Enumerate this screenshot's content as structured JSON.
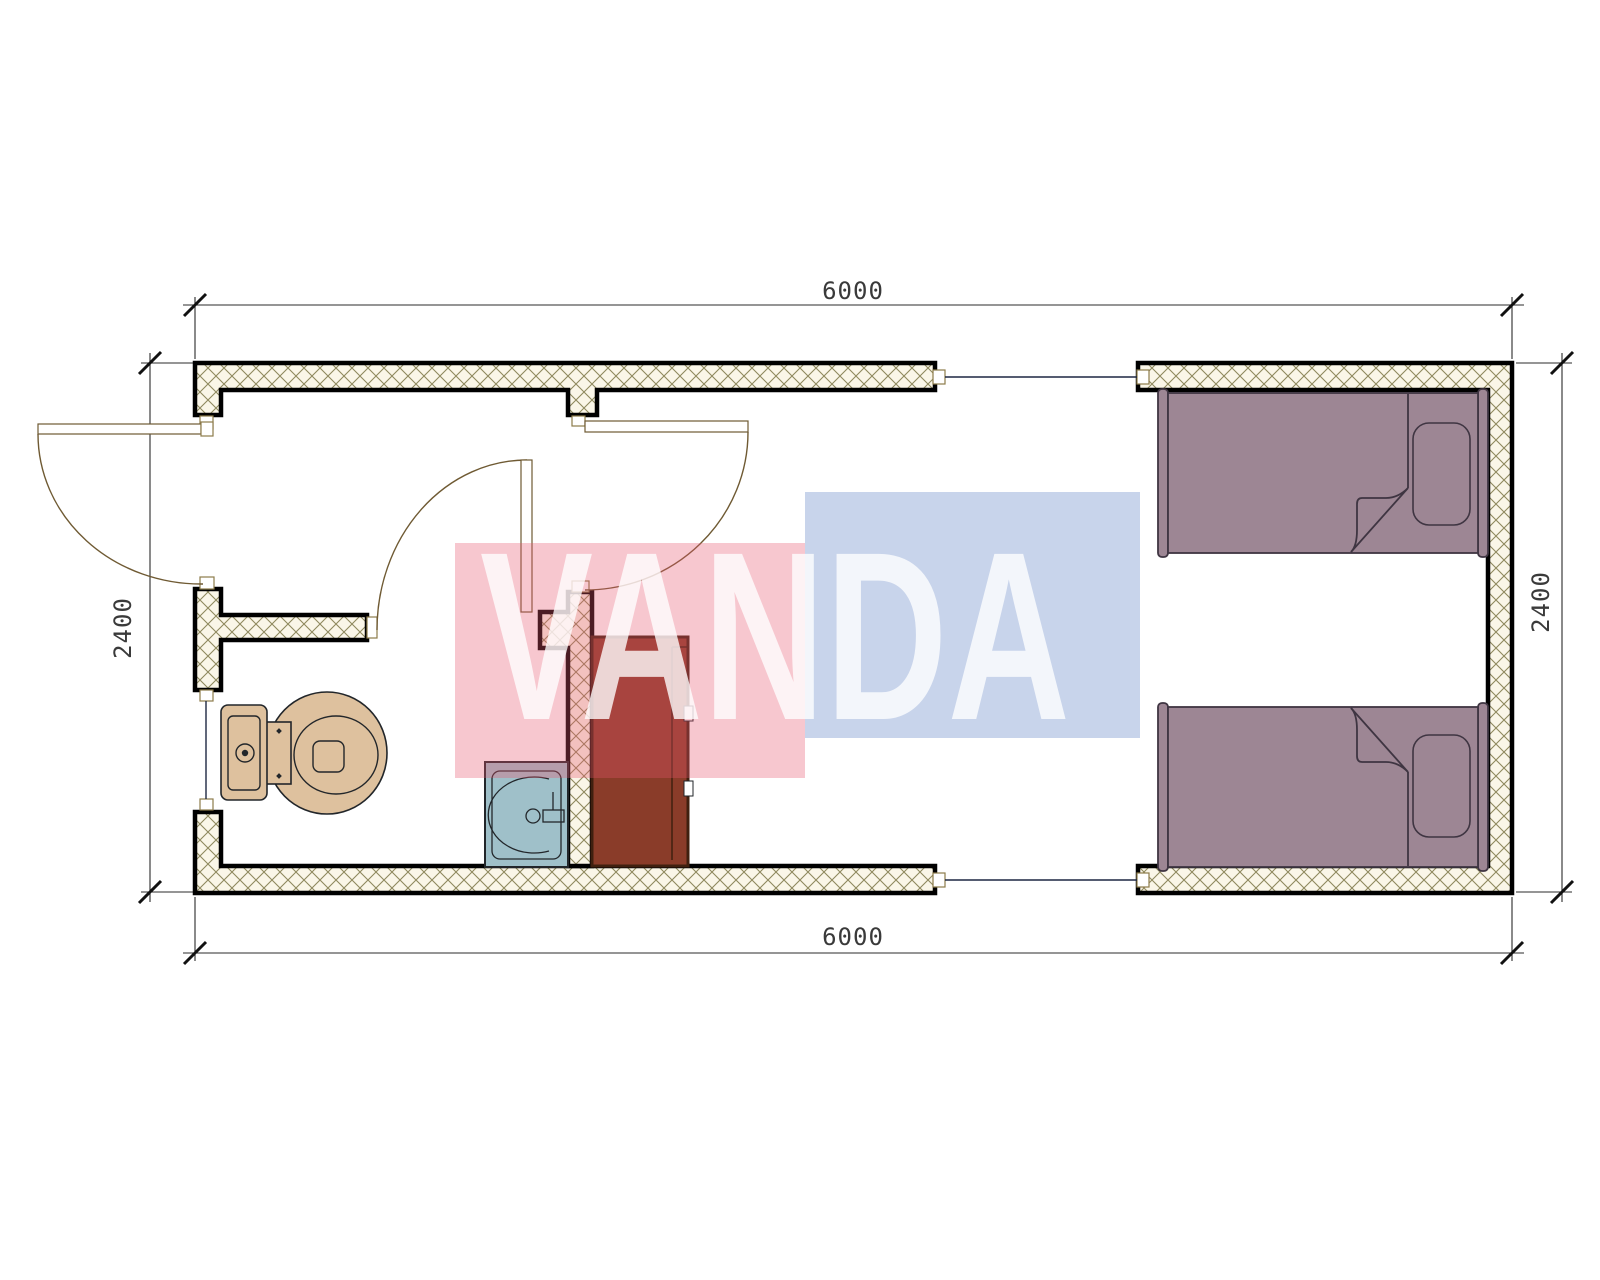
{
  "dimensions": {
    "top_width": "6000",
    "bottom_width": "6000",
    "left_height": "2400",
    "right_height": "2400"
  },
  "watermark": {
    "text": "VANDA"
  },
  "fixtures": [
    "toilet",
    "sink",
    "cabinet",
    "single-bed",
    "single-bed"
  ],
  "openings": {
    "doors": 3,
    "windows": 1,
    "module_connectors": 2
  },
  "colors": {
    "paper": "#ffffff",
    "wall_fill": "#faf6e8",
    "hatch_line": "#8f895e",
    "wall_stroke": "#000000",
    "cap_stroke": "#8d7b4a",
    "dim_line": "#2b2b2b",
    "tick": "#111111",
    "dim_text": "#3a3a3a",
    "connector": "#1d2742",
    "door": "#6f5a33",
    "toilet_fill": "#dec19e",
    "sink_fill": "#9fc0c9",
    "fixture_stroke": "#22262a",
    "cabinet_fill": "#8a3c29",
    "cabinet_stroke": "#40200f",
    "bed_fill": "#9d8694",
    "bed_stroke": "#3f3542",
    "wm_red": "rgba(230,85,110,0.33)",
    "wm_blue": "rgba(95,130,195,0.34)",
    "wm_letter": "rgba(255,255,255,0.78)"
  }
}
